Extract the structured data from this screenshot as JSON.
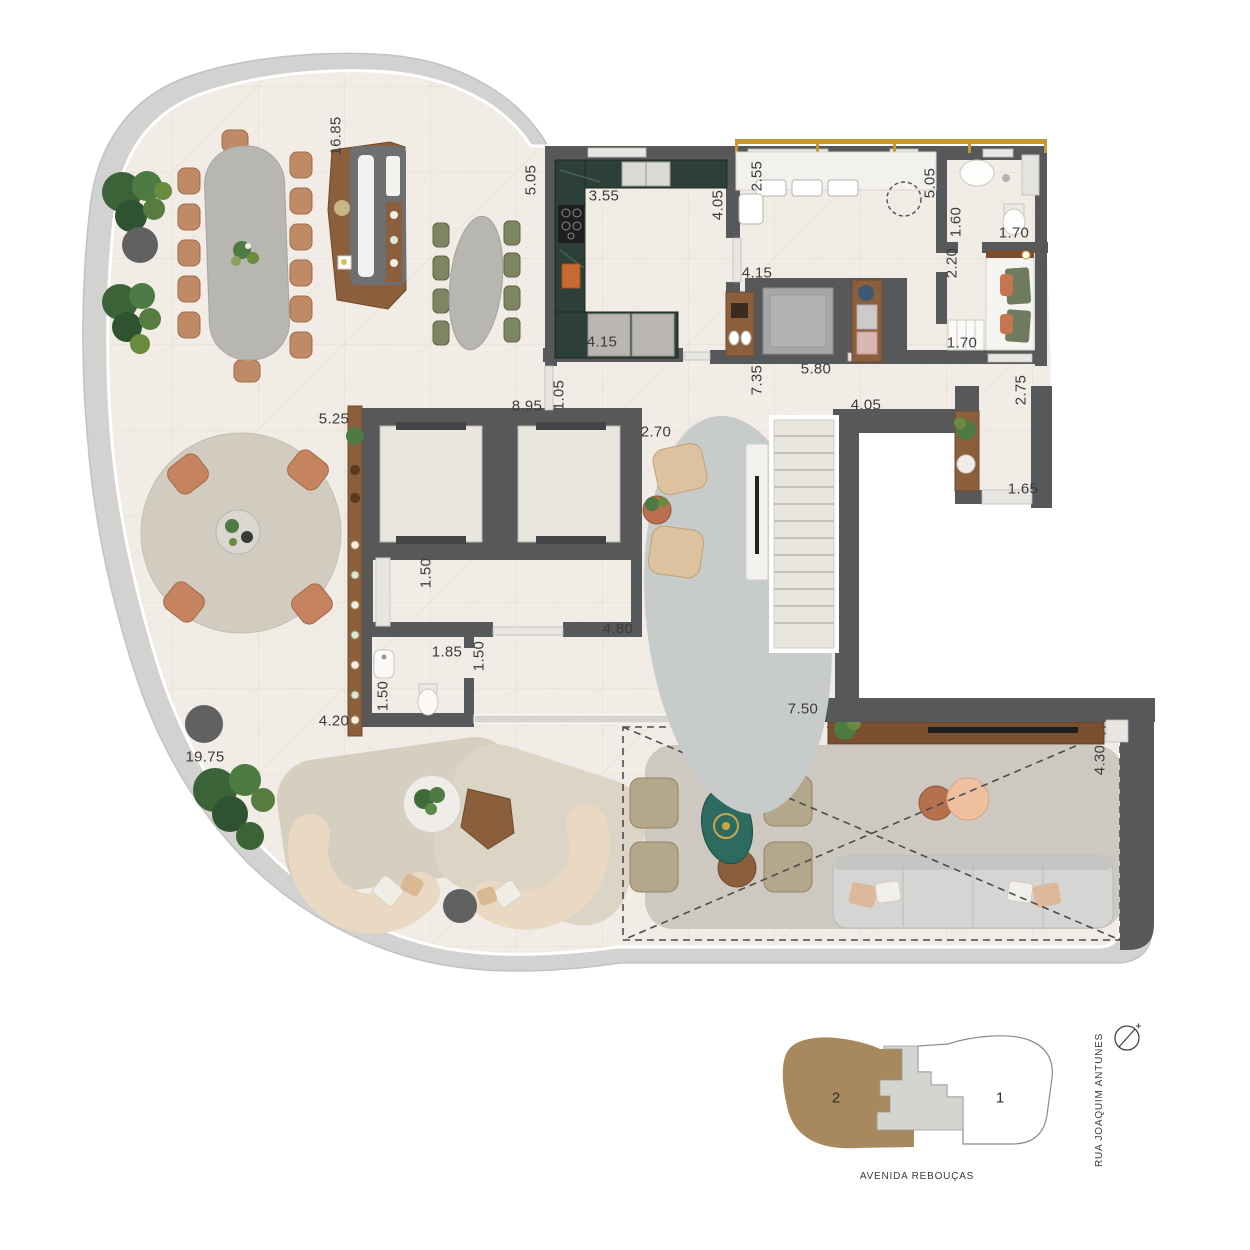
{
  "dims": {
    "d1": "16.85",
    "d2": "5.05",
    "d3": "3.55",
    "d4": "4.05",
    "d5": "2.55",
    "d6": "5.05",
    "d7": "1.60",
    "d8": "1.70",
    "d9": "2.20",
    "d10": "1.70",
    "d11": "2.75",
    "d12": "4.15",
    "d13": "4.15",
    "d14": "7.35",
    "d15": "5.80",
    "d16": "1.05",
    "d17": "8.95",
    "d18": "4.05",
    "d19": "5.25",
    "d20": "2.70",
    "d21": "1.65",
    "d22": "1.50",
    "d23": "4.80",
    "d24": "1.85",
    "d25": "1.50",
    "d26": "1.50",
    "d27": "4.20",
    "d28": "19.75",
    "d29": "7.50",
    "d30": "4.30"
  },
  "key_plan": {
    "unit_1_label": "1",
    "unit_2_label": "2",
    "street_right": "RUA JOAQUIM ANTUNES",
    "street_bottom": "AVENIDA REBOUÇAS"
  },
  "colors": {
    "wall": "#57585a",
    "terrace_band": "#d2d2d0",
    "floor": "#f1ece5",
    "counter_green": "#2c3f38",
    "wood": "#8b5e3c",
    "wood_dark": "#7a4f30",
    "tan_chair": "#c08a66",
    "olive_chair": "#7d8563",
    "teal_table": "#2d6a60",
    "window_gold": "#c9952c",
    "keyplan_unit2": "#a8895e",
    "sofa_cream": "#ead9c2"
  }
}
